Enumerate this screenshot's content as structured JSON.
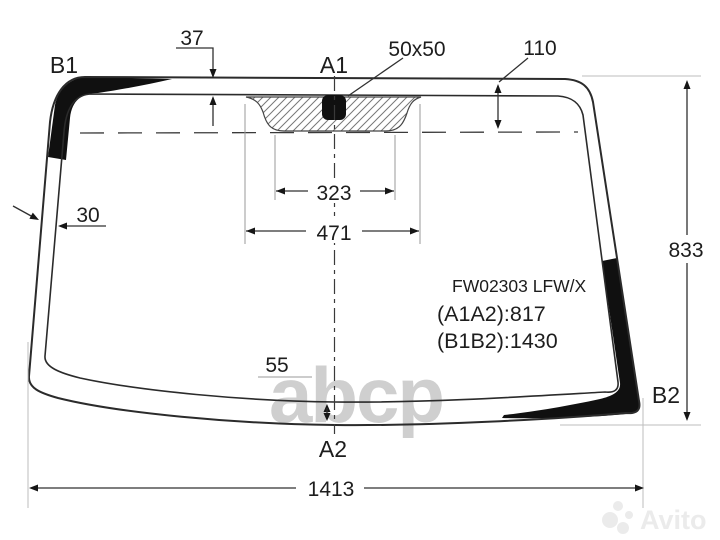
{
  "labels": {
    "b1": "B1",
    "a1": "A1",
    "a2": "A2",
    "b2": "B2"
  },
  "part": {
    "code": "FW02303 LFW/X",
    "a1a2": "(A1A2):817",
    "b1b2": "(B1B2):1430"
  },
  "dims": {
    "top_band": "37",
    "sensor_size": "50x50",
    "frit_depth": "110",
    "frit_inner_width": "323",
    "frit_outer_width": "471",
    "left_band": "30",
    "bottom_band": "55",
    "height": "833",
    "width": "1413"
  },
  "watermarks": {
    "center": "abcp",
    "corner": "Avito"
  },
  "colors": {
    "background": "#ffffff",
    "line": "#2b2b2b",
    "band_black": "#101010",
    "dimension": "#303030",
    "extension": "#9a9a9a",
    "watermark_center": "#c4c4c4",
    "watermark_corner": "#ebebeb"
  }
}
